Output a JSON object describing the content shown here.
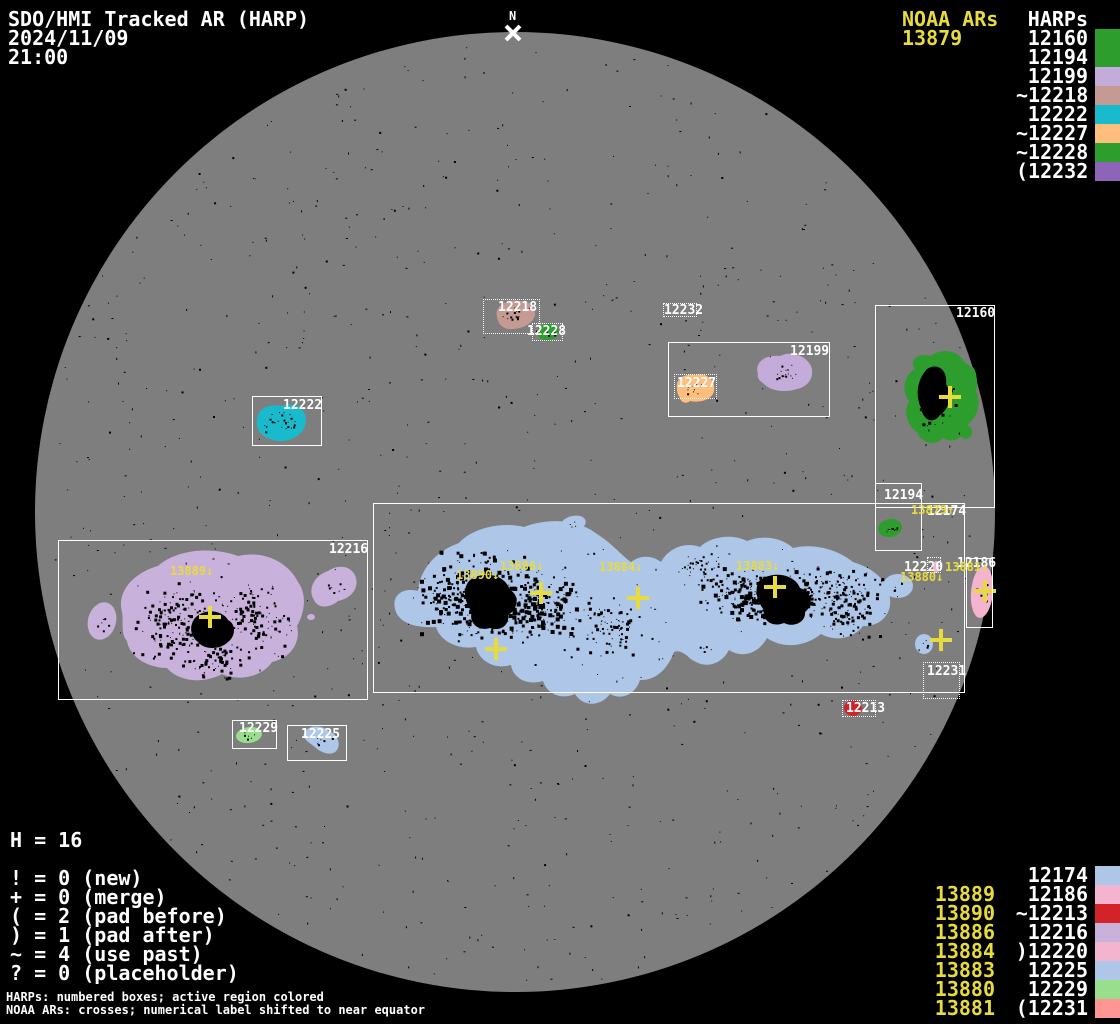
{
  "title": {
    "app": "SDO/HMI Tracked AR (HARP)",
    "date": "2024/11/09",
    "time": "21:00"
  },
  "north": {
    "label": "N"
  },
  "legend_top": {
    "noaa_header": "NOAA ARs",
    "noaa_value": "13879",
    "harps_header": "HARPs",
    "items": [
      {
        "label": "12160",
        "color": "#2D9E2D"
      },
      {
        "label": "12194",
        "color": "#2D9E2D"
      },
      {
        "label": "12199",
        "color": "#C3ACD9"
      },
      {
        "label": "~12218",
        "color": "#C49A92"
      },
      {
        "label": "12222",
        "color": "#19BACC"
      },
      {
        "label": "~12227",
        "color": "#FFBE7D"
      },
      {
        "label": "~12228",
        "color": "#2D9E2D"
      },
      {
        "label": "(12232",
        "color": "#8E64B8"
      }
    ]
  },
  "legend_bottom": {
    "rows": [
      {
        "noaa": "",
        "harp": "12174",
        "color": "#AEC6E8"
      },
      {
        "noaa": "13889",
        "harp": "12186",
        "color": "#F4B4D0"
      },
      {
        "noaa": "13890",
        "harp": "~12213",
        "color": "#D22428"
      },
      {
        "noaa": "13886",
        "harp": "12216",
        "color": "#C8B2DC"
      },
      {
        "noaa": "13884",
        "harp": ")12220",
        "color": "#F4B4D0"
      },
      {
        "noaa": "13883",
        "harp": "12225",
        "color": "#AEC6E8"
      },
      {
        "noaa": "13880",
        "harp": "12229",
        "color": "#98DE8C"
      },
      {
        "noaa": "13881",
        "harp": "(12231",
        "color": "#FF9694"
      }
    ]
  },
  "stats": {
    "total": "H = 16",
    "lines": [
      "! = 0 (new)",
      "+ = 0 (merge)",
      "( = 2 (pad before)",
      ") = 1 (pad after)",
      "~ = 4 (use past)",
      "? = 0 (placeholder)"
    ]
  },
  "footer": {
    "line1": "HARPs: numbered boxes; active region colored",
    "line2": "NOAA ARs: crosses; numerical label shifted to near equator"
  },
  "colors": {
    "background": "#000000",
    "disk": "#7E7E7E",
    "annotation_yellow": "#E8DC3C",
    "annotation_white": "#FFFFFF"
  },
  "map": {
    "boxes": [
      {
        "harp": "12160",
        "x": 875,
        "y": 305,
        "w": 120,
        "h": 203,
        "style": "solid",
        "label_x": 956,
        "label_y": 307
      },
      {
        "harp": "12194",
        "x": 875,
        "y": 483,
        "w": 47,
        "h": 68,
        "style": "solid",
        "label_x": 884,
        "label_y": 489
      },
      {
        "harp": "12199",
        "x": 668,
        "y": 342,
        "w": 162,
        "h": 75,
        "style": "solid",
        "label_x": 790,
        "label_y": 345
      },
      {
        "harp": "12218",
        "x": 483,
        "y": 299,
        "w": 57,
        "h": 35,
        "style": "dotted",
        "label_x": 498,
        "label_y": 301
      },
      {
        "harp": "12222",
        "x": 252,
        "y": 396,
        "w": 70,
        "h": 50,
        "style": "solid",
        "label_x": 283,
        "label_y": 399
      },
      {
        "harp": "12227",
        "x": 674,
        "y": 374,
        "w": 43,
        "h": 25,
        "style": "dotted",
        "label_x": 677,
        "label_y": 377
      },
      {
        "harp": "12228",
        "x": 532,
        "y": 323,
        "w": 31,
        "h": 18,
        "style": "dotted",
        "label_x": 527,
        "label_y": 325
      },
      {
        "harp": "12232",
        "x": 663,
        "y": 303,
        "w": 34,
        "h": 14,
        "style": "dotted",
        "label_x": 664,
        "label_y": 304
      },
      {
        "harp": "12174",
        "x": 373,
        "y": 503,
        "w": 592,
        "h": 190,
        "style": "solid",
        "label_x": 927,
        "label_y": 505
      },
      {
        "harp": "12186",
        "x": 966,
        "y": 558,
        "w": 27,
        "h": 70,
        "style": "solid",
        "label_x": 957,
        "label_y": 557
      },
      {
        "harp": "12213",
        "x": 842,
        "y": 700,
        "w": 34,
        "h": 17,
        "style": "dotted",
        "label_x": 846,
        "label_y": 702
      },
      {
        "harp": "12216",
        "x": 58,
        "y": 540,
        "w": 310,
        "h": 160,
        "style": "solid",
        "label_x": 329,
        "label_y": 543
      },
      {
        "harp": "12220",
        "x": 927,
        "y": 557,
        "w": 14,
        "h": 16,
        "style": "dotted",
        "label_x": 904,
        "label_y": 561
      },
      {
        "harp": "12225",
        "x": 287,
        "y": 725,
        "w": 60,
        "h": 36,
        "style": "solid",
        "label_x": 301,
        "label_y": 728
      },
      {
        "harp": "12229",
        "x": 232,
        "y": 720,
        "w": 45,
        "h": 29,
        "style": "solid",
        "label_x": 239,
        "label_y": 722
      },
      {
        "harp": "12231",
        "x": 923,
        "y": 662,
        "w": 37,
        "h": 37,
        "style": "dotted",
        "label_x": 927,
        "label_y": 665
      }
    ],
    "crosses": [
      {
        "noaa": "13879",
        "x": 950,
        "y": 397,
        "label": "13879↑",
        "label_x": 911,
        "label_y": 504
      },
      {
        "noaa": "13889",
        "x": 210,
        "y": 617,
        "label": "13889↓",
        "label_x": 170,
        "label_y": 565
      },
      {
        "noaa": "13890",
        "x": 496,
        "y": 649,
        "label": "13890↓",
        "label_x": 456,
        "label_y": 569
      },
      {
        "noaa": "13886",
        "x": 541,
        "y": 593,
        "label": "13886↓",
        "label_x": 500,
        "label_y": 560
      },
      {
        "noaa": "13884",
        "x": 638,
        "y": 598,
        "label": "13884↓",
        "label_x": 599,
        "label_y": 561
      },
      {
        "noaa": "13883",
        "x": 775,
        "y": 587,
        "label": "13883↓",
        "label_x": 736,
        "label_y": 560
      },
      {
        "noaa": "13880",
        "x": 941,
        "y": 640,
        "label": "13880↓",
        "label_x": 900,
        "label_y": 571
      },
      {
        "noaa": "13881",
        "x": 985,
        "y": 591,
        "label": "13881↓",
        "label_x": 945,
        "label_y": 561
      }
    ],
    "regions": [
      {
        "harp": "12216",
        "color": "#C8B2DC",
        "shapes": [
          {
            "t": "p",
            "d": "M122,612 C116,590 136,572 158,566 C176,550 210,546 238,556 C264,550 288,562 298,582 C307,594 305,612 297,626 C301,642 291,658 272,662 C263,676 240,682 222,674 C204,684 179,682 167,668 C147,668 129,656 127,641 C120,633 124,622 122,612 Z"
          },
          {
            "t": "e",
            "cx": 102,
            "cy": 621,
            "rx": 14,
            "ry": 19,
            "rot": 15
          },
          {
            "t": "p",
            "d": "M314,600 C307,589 315,575 328,571 C340,563 353,567 356,578 C359,590 349,599 338,601 C330,608 318,609 314,600 Z"
          },
          {
            "t": "e",
            "cx": 311,
            "cy": 617,
            "rx": 4,
            "ry": 3,
            "rot": 0
          }
        ]
      },
      {
        "harp": "12199",
        "color": "#C3ACD9",
        "shapes": [
          {
            "t": "p",
            "d": "M758,374 C754,362 766,354 780,356 C792,350 806,356 811,366 C815,377 808,387 797,389 C786,393 770,391 764,384 C759,380 757,378 758,374 Z"
          }
        ]
      },
      {
        "harp": "12218",
        "color": "#C49A92",
        "shapes": [
          {
            "t": "p",
            "d": "M497,317 C494,306 507,299 519,301 C529,300 536,307 535,315 C533,324 521,330 508,329 C500,327 498,322 497,317 Z"
          }
        ]
      },
      {
        "harp": "12228",
        "color": "#2D9E2D",
        "shapes": [
          {
            "t": "e",
            "cx": 548,
            "cy": 332,
            "rx": 11,
            "ry": 8,
            "rot": -10
          }
        ]
      },
      {
        "harp": "12227",
        "color": "#FFBE7D",
        "shapes": [
          {
            "t": "p",
            "d": "M677,389 C675,378 685,373 696,375 C707,372 716,381 714,391 C712,400 700,403 690,401 C687,404 681,403 680,398 C678,395 677,393 677,389 Z"
          }
        ]
      },
      {
        "harp": "12222",
        "color": "#19BACC",
        "shapes": [
          {
            "t": "p",
            "d": "M257,425 C255,410 267,403 281,406 C295,401 307,409 306,421 C305,434 292,442 278,441 C266,439 258,434 257,425 Z"
          }
        ]
      },
      {
        "harp": "12160",
        "color": "#2D9E2D",
        "shapes": [
          {
            "t": "p",
            "d": "M915,369 C908,360 919,352 931,356 C943,347 959,351 964,362 C974,367 980,379 976,391 C982,404 977,418 967,425 C966,437 953,445 943,438 C935,447 921,443 917,432 C907,426 903,412 909,401 C901,391 904,375 915,369 Z"
          },
          {
            "t": "e",
            "cx": 966,
            "cy": 432,
            "rx": 6,
            "ry": 7,
            "rot": 0
          },
          {
            "t": "p",
            "d": "M972,366 C977,371 978,381 975,389 C972,383 970,373 972,366 Z"
          }
        ]
      },
      {
        "harp": "12194",
        "color": "#2D9E2D",
        "shapes": [
          {
            "t": "e",
            "cx": 890,
            "cy": 528,
            "rx": 12,
            "ry": 9,
            "rot": -10
          }
        ]
      },
      {
        "harp": "12174",
        "color": "#AEC6E8",
        "shapes": [
          {
            "t": "p",
            "d": "M396,612 C390,596 402,587 418,591 C420,568 437,551 459,543 C471,529 500,521 524,527 C549,517 579,520 597,534 C613,544 622,556 631,562 C640,555 652,555 661,562 C668,549 684,541 700,547 C710,537 731,533 747,541 C761,535 781,537 793,548 C813,543 837,549 853,562 C873,568 889,581 890,599 C892,615 879,627 863,626 C855,637 837,643 821,634 C805,647 783,649 767,638 C759,653 743,659 729,650 C721,665 705,669 693,660 C686,655 680,649 674,652 C668,669 655,681 640,680 C636,693 623,701 610,694 C600,707 583,707 575,694 C561,700 547,694 543,681 C527,686 513,678 511,665 C495,670 479,661 476,647 C458,650 440,641 436,627 C417,628 401,624 396,612 Z"
          },
          {
            "t": "e",
            "cx": 573,
            "cy": 524,
            "rx": 13,
            "ry": 8,
            "rot": -15
          },
          {
            "t": "e",
            "cx": 707,
            "cy": 650,
            "rx": 21,
            "ry": 13,
            "rot": -5
          },
          {
            "t": "e",
            "cx": 898,
            "cy": 586,
            "rx": 15,
            "ry": 12,
            "rot": 0
          },
          {
            "t": "e",
            "cx": 924,
            "cy": 644,
            "rx": 9,
            "ry": 10,
            "rot": 0
          }
        ]
      },
      {
        "harp": "12186",
        "color": "#F4B4D0",
        "shapes": [
          {
            "t": "e",
            "cx": 982,
            "cy": 592,
            "rx": 11,
            "ry": 26,
            "rot": 5
          }
        ]
      },
      {
        "harp": "12220",
        "color": "#F4B4D0",
        "shapes": [
          {
            "t": "e",
            "cx": 936,
            "cy": 567,
            "rx": 3,
            "ry": 6,
            "rot": 0
          }
        ]
      },
      {
        "harp": "12213",
        "color": "#D22428",
        "shapes": [
          {
            "t": "e",
            "cx": 853,
            "cy": 708,
            "rx": 9,
            "ry": 8,
            "rot": 0
          }
        ]
      },
      {
        "harp": "12225",
        "color": "#AEC6E8",
        "shapes": [
          {
            "t": "p",
            "d": "M304,733 C308,725 320,724 329,731 C338,735 341,744 337,750 C333,756 323,754 316,748 C309,742 302,739 304,733 Z"
          }
        ]
      },
      {
        "harp": "12229",
        "color": "#98DE8C",
        "shapes": [
          {
            "t": "e",
            "cx": 249,
            "cy": 735,
            "rx": 13,
            "ry": 8,
            "rot": -8
          }
        ]
      }
    ],
    "cores": [
      {
        "d": "M927,369 C938,362 948,371 946,384 C953,395 949,409 940,415 C933,425 923,420 921,408 C915,395 917,380 927,369 Z"
      },
      {
        "d": "M470,580 C485,570 505,575 510,590 C520,595 518,610 508,615 C510,625 500,632 490,628 C478,632 468,622 472,612 C464,602 462,588 470,580 Z"
      },
      {
        "d": "M760,580 C775,570 795,575 800,588 C812,592 814,605 805,612 C806,622 794,628 784,623 C772,628 762,620 764,610 C756,600 754,588 760,580 Z"
      },
      {
        "d": "M195,618 C205,608 222,610 228,620 C236,624 236,636 228,642 C220,650 204,650 198,642 C190,636 189,626 195,618 Z"
      }
    ]
  }
}
